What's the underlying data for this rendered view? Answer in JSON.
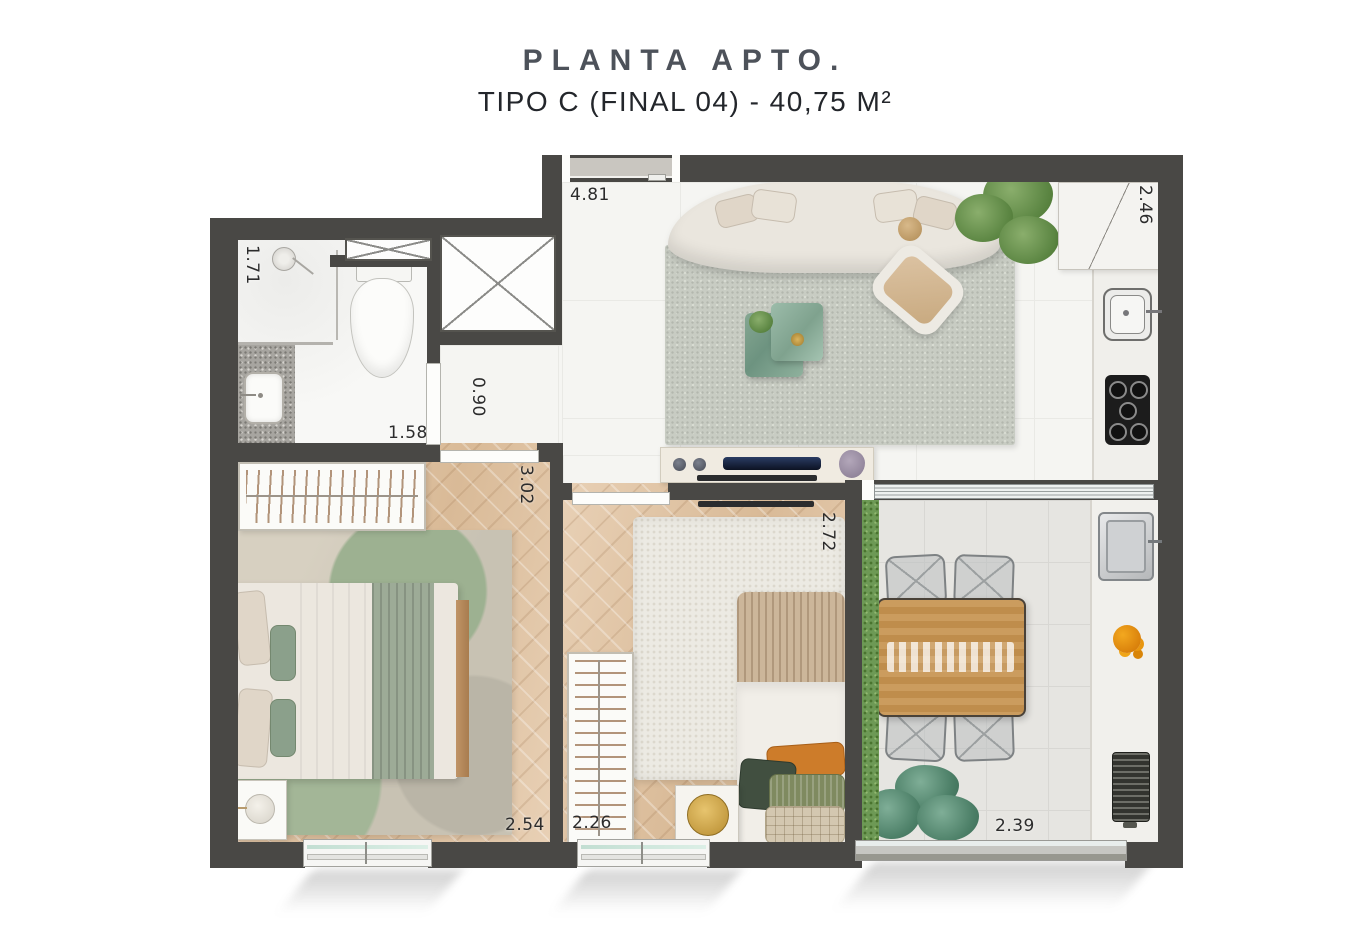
{
  "header": {
    "title": "PLANTA APTO.",
    "subtitle": "TIPO C (FINAL 04) - 40,75 M²"
  },
  "plan": {
    "dimensions": {
      "living": "4.81",
      "kitchen": "2.46",
      "bathroom_width": "1.71",
      "bathroom_length": "1.58",
      "hallway": "0.90",
      "bedroom1_length": "3.02",
      "bedroom1_width": "2.54",
      "bedroom2_width": "2.26",
      "bedroom2_length": "2.72",
      "balcony": "2.39"
    },
    "colors": {
      "wall": "#494845",
      "wood_floor": "#e0c5a8",
      "garden_green": "#6d9955"
    }
  }
}
